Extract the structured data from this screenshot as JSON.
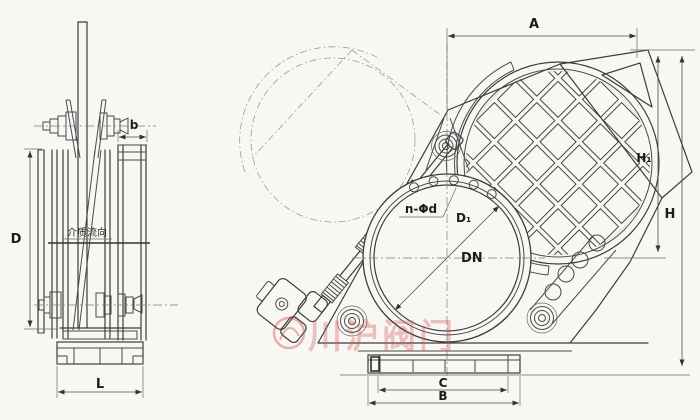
{
  "drawing": {
    "type": "valve-engineering-drawing-two-views",
    "views": [
      "side-elevation",
      "front-elevation"
    ]
  },
  "labels": {
    "side": {
      "flow": "介质流向",
      "b": "b",
      "D": "D",
      "L": "L"
    },
    "front": {
      "A": "A",
      "H1": "H₁",
      "H": "H",
      "C": "C",
      "B": "B",
      "n_phi_d": "n-Φd",
      "D1": "D₁",
      "DN": "DN"
    }
  },
  "watermark": {
    "text": "川沪阀门"
  },
  "colors": {
    "paper": "#f8f7f3",
    "line": "#3d3d3d",
    "dim": "#4a4a4a",
    "centerline": "#7c7c7c",
    "watermark": "rgba(205,80,75,0.35)"
  }
}
